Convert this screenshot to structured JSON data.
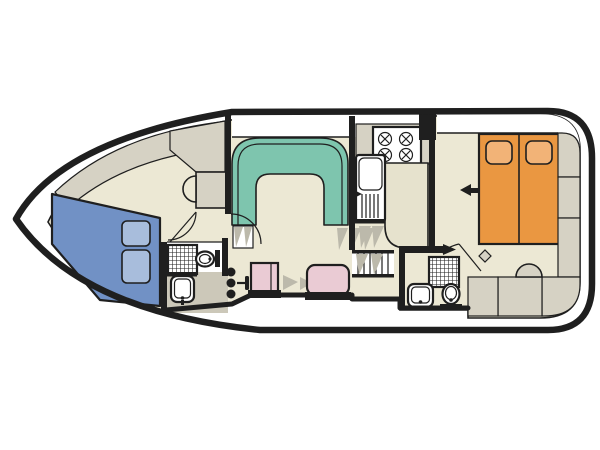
{
  "diagram": {
    "type": "boat-floor-plan",
    "view": "top-down deck plan, bow pointing left",
    "rooms": [
      {
        "name": "bow-cabin",
        "furniture": [
          "v-berth-bed",
          "two-pillows",
          "wash-basin",
          "wardrobe",
          "hull-side-shelf",
          "door"
        ]
      },
      {
        "name": "front-bathroom",
        "furniture": [
          "shower-tray",
          "toilet",
          "wash-sink"
        ]
      },
      {
        "name": "saloon",
        "furniture": [
          "u-shaped-dinette",
          "entry-steps"
        ]
      },
      {
        "name": "galley",
        "furniture": [
          "four-burner-stove",
          "sink-with-drainer",
          "counter-unit"
        ]
      },
      {
        "name": "helm-area",
        "furniture": [
          "engine-control-knobs",
          "throttle-lever",
          "helm-seat",
          "companion-seat"
        ]
      },
      {
        "name": "companionway",
        "furniture": [
          "stairs-with-treads"
        ]
      },
      {
        "name": "aft-bathroom",
        "furniture": [
          "shower-tray",
          "toilet",
          "wash-sink",
          "door"
        ]
      },
      {
        "name": "aft-cabin",
        "furniture": [
          "double-bed",
          "two-pillows",
          "wardrobe-units",
          "bench-seats",
          "semicircle-stool",
          "hook"
        ]
      }
    ],
    "annotations": [
      {
        "name": "direction-arrow",
        "shape": "arrow-pointing-left",
        "location": "aft-cabin beside double-bed"
      },
      {
        "name": "entry-arrow",
        "shape": "arrow-pointing-right",
        "location": "aft-bathroom top wall"
      }
    ],
    "counts": {
      "stove_burners": 4,
      "bow_pillows": 2,
      "aft_pillows": 2,
      "control_knobs": 3
    }
  },
  "colors": {
    "background": "#ffffff",
    "hull": "#1f1f1f",
    "wall": "#1f1f1f",
    "floor": "#ECE8D4",
    "deck_white": "#ffffff",
    "cabinet": "#D6D2C4",
    "counter_light": "#E6E2CD",
    "bathroom_floor": "#CCC8B9",
    "dinette_teal": "#7EC5AE",
    "bed_blue": "#7191C5",
    "pillow_blue": "#A8BDDC",
    "bed_orange": "#EA9741",
    "pillow_orange": "#F2B377",
    "seat_pink": "#EACBD4",
    "shading": "#BCB9AB",
    "fixture_white": "#ffffff"
  }
}
